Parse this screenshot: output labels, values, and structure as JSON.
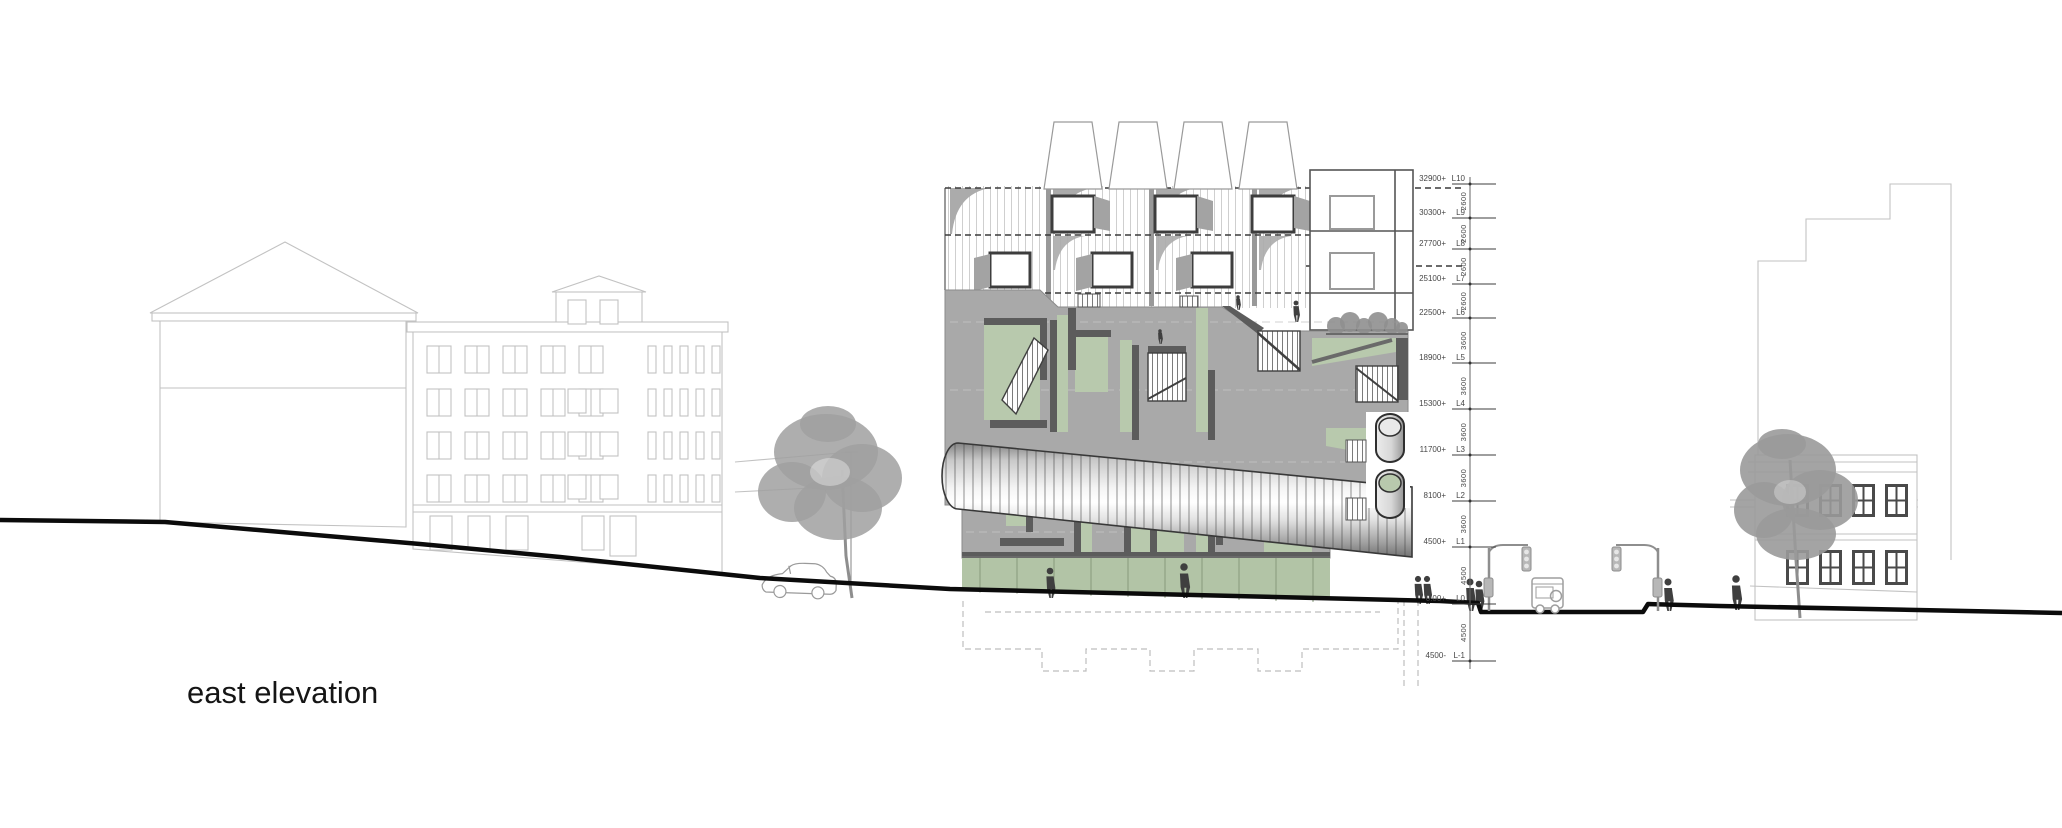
{
  "title": {
    "label": "east elevation"
  },
  "colors": {
    "concrete": "#a9a9a9",
    "concrete_shadow": "#8f8f8f",
    "frame_dark": "#4a4a4a",
    "maze_dark": "#5c5c5c",
    "courtyard_green": "#b8c9ad",
    "storefront_green": "#b2c4a6",
    "outline_light": "#c2c2c2",
    "outline_mid": "#9a9a9a",
    "ground_line": "#0b0b0b",
    "label_ink": "#474747",
    "title_ink": "#151515"
  },
  "levels": {
    "axis_x": 1470,
    "marks": [
      {
        "elevation": "32900+",
        "level": "L10",
        "y": 184
      },
      {
        "elevation": "30300+",
        "level": "L9",
        "y": 218
      },
      {
        "elevation": "27700+",
        "level": "L8",
        "y": 249
      },
      {
        "elevation": "25100+",
        "level": "L7",
        "y": 284
      },
      {
        "elevation": "22500+",
        "level": "L6",
        "y": 318
      },
      {
        "elevation": "18900+",
        "level": "L5",
        "y": 363
      },
      {
        "elevation": "15300+",
        "level": "L4",
        "y": 409
      },
      {
        "elevation": "11700+",
        "level": "L3",
        "y": 455
      },
      {
        "elevation": "8100+",
        "level": "L2",
        "y": 501
      },
      {
        "elevation": "4500+",
        "level": "L1",
        "y": 547
      },
      {
        "elevation": "0.00+",
        "level": "L0",
        "y": 604
      },
      {
        "elevation": "4500-",
        "level": "L-1",
        "y": 661
      }
    ],
    "dims": [
      "2600",
      "2600",
      "2600",
      "2600",
      "3600",
      "3600",
      "3600",
      "3600",
      "3600",
      "4500",
      "4500"
    ]
  }
}
